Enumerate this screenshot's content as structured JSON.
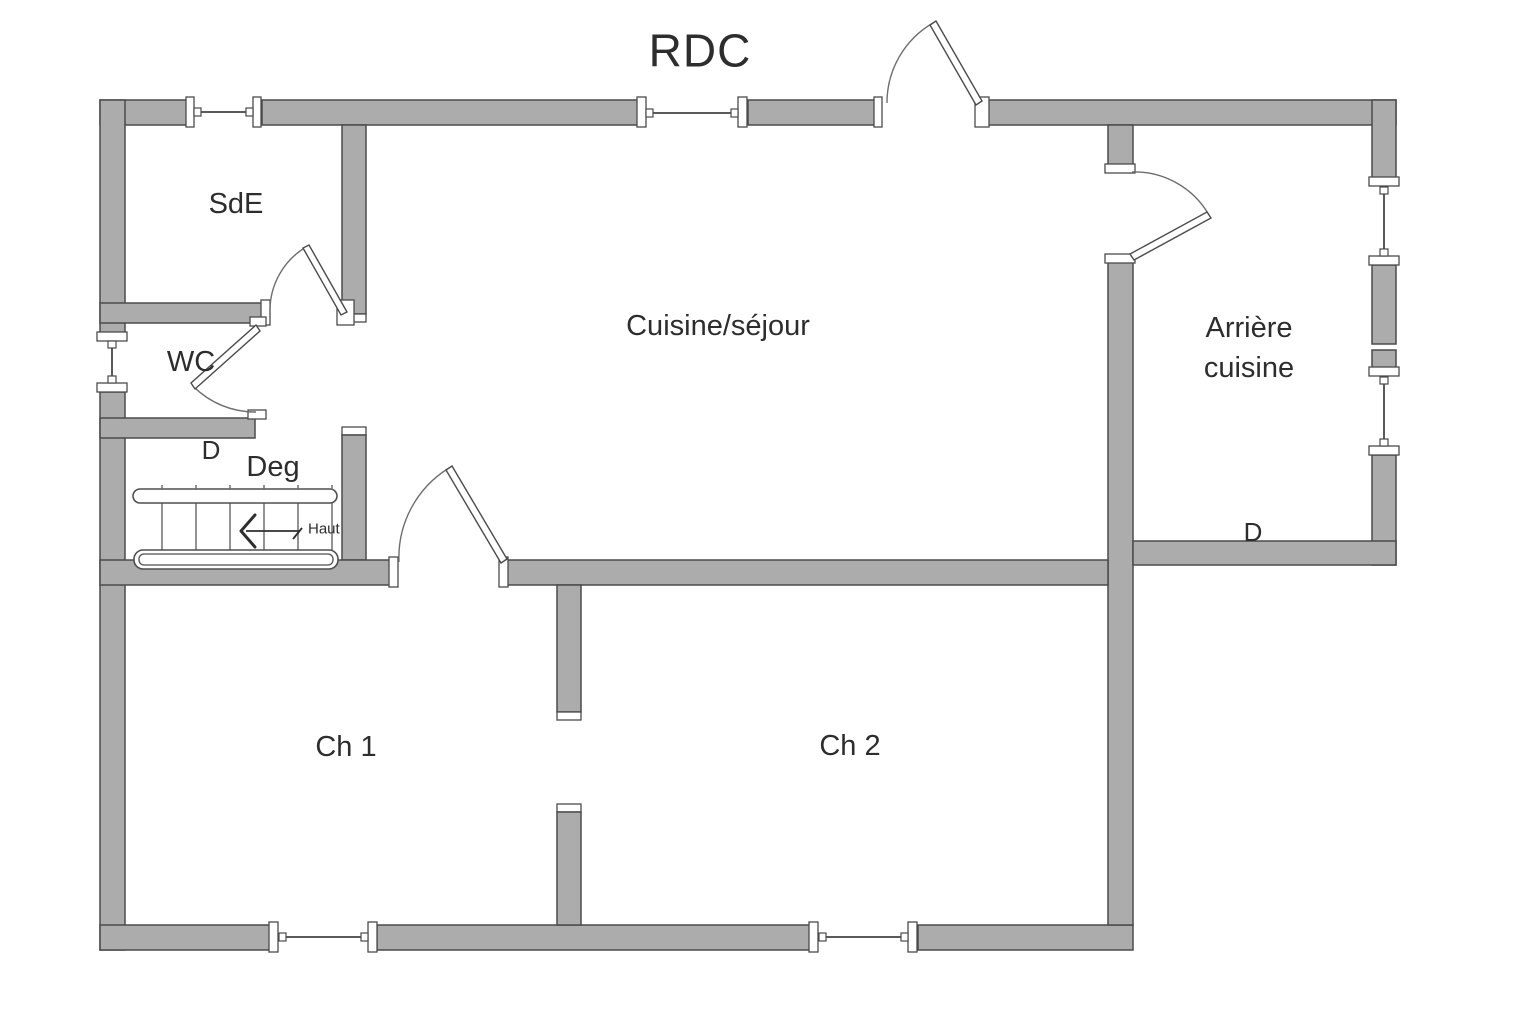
{
  "title": "RDC",
  "rooms": {
    "sde": {
      "label": "SdE"
    },
    "wc": {
      "label": "WC"
    },
    "deg": {
      "label": "Deg",
      "door_label": "D"
    },
    "cuisine_sejour": {
      "label": "Cuisine/séjour"
    },
    "arriere_cuisine": {
      "label_line1": "Arrière",
      "label_line2": "cuisine",
      "door_label": "D"
    },
    "ch1": {
      "label": "Ch 1"
    },
    "ch2": {
      "label": "Ch 2"
    }
  },
  "stairs": {
    "direction_label": "Haut"
  },
  "colors": {
    "background": "#ffffff",
    "wall_fill": "#acacac",
    "wall_outline": "#4b4b4b",
    "text": "#2d2d2d"
  }
}
